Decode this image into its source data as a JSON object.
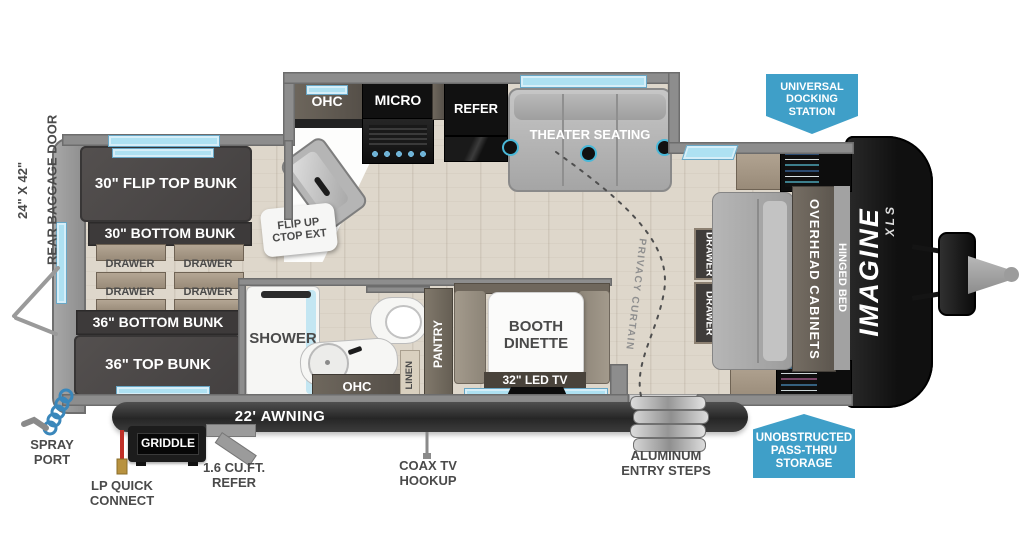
{
  "colors": {
    "accent_blue": "#3f9fc8",
    "window_blue": "#aee1f2",
    "wall_gray": "#8d8d8d",
    "floor_tan": "#ded7cb",
    "dark_furniture": "#4b4848",
    "label_gray": "#4a4a4a"
  },
  "exterior": {
    "rear_door_size": "24\" X 42\"",
    "rear_door_name": "REAR BAGGAGE DOOR",
    "spray_port": "SPRAY\nPORT",
    "lp_quick_connect": "LP QUICK\nCONNECT",
    "griddle": "GRIDDLE",
    "refer_small": "1.6 CU.FT.\nREFER",
    "coax": "COAX TV\nHOOKUP",
    "awning": "22' AWNING",
    "entry_steps": "ALUMINUM\nENTRY STEPS",
    "badge_docking": "UNIVERSAL\nDOCKING\nSTATION",
    "badge_passthru": "UNOBSTRUCTED\nPASS-THRU\nSTORAGE",
    "logo_name": "IMAGINE",
    "logo_series": "XLS"
  },
  "bunk_room": {
    "flip_top_bunk": "30\" FLIP TOP BUNK",
    "bottom_bunk": "30\" BOTTOM BUNK",
    "drawers": [
      "DRAWER",
      "DRAWER",
      "DRAWER",
      "DRAWER"
    ],
    "bottom_bunk_36": "36\" BOTTOM BUNK",
    "top_bunk_36": "36\" TOP BUNK"
  },
  "kitchen": {
    "ohc": "OHC",
    "micro": "MICRO",
    "refer": "REFER",
    "flip_up_ctop": "FLIP UP\nCTOP EXT"
  },
  "living": {
    "theater": "THEATER SEATING",
    "privacy_curtain": "PRIVACY CURTAIN",
    "booth_dinette": "BOOTH\nDINETTE",
    "tv": "32\" LED TV"
  },
  "bath": {
    "shower": "SHOWER",
    "ohc": "OHC",
    "linen": "LINEN",
    "pantry": "PANTRY"
  },
  "bedroom": {
    "drawer1": "DRAWER",
    "drawer2": "DRAWER",
    "overhead_cabinets": "OVERHEAD CABINETS",
    "hinged_bed": "HINGED BED"
  }
}
